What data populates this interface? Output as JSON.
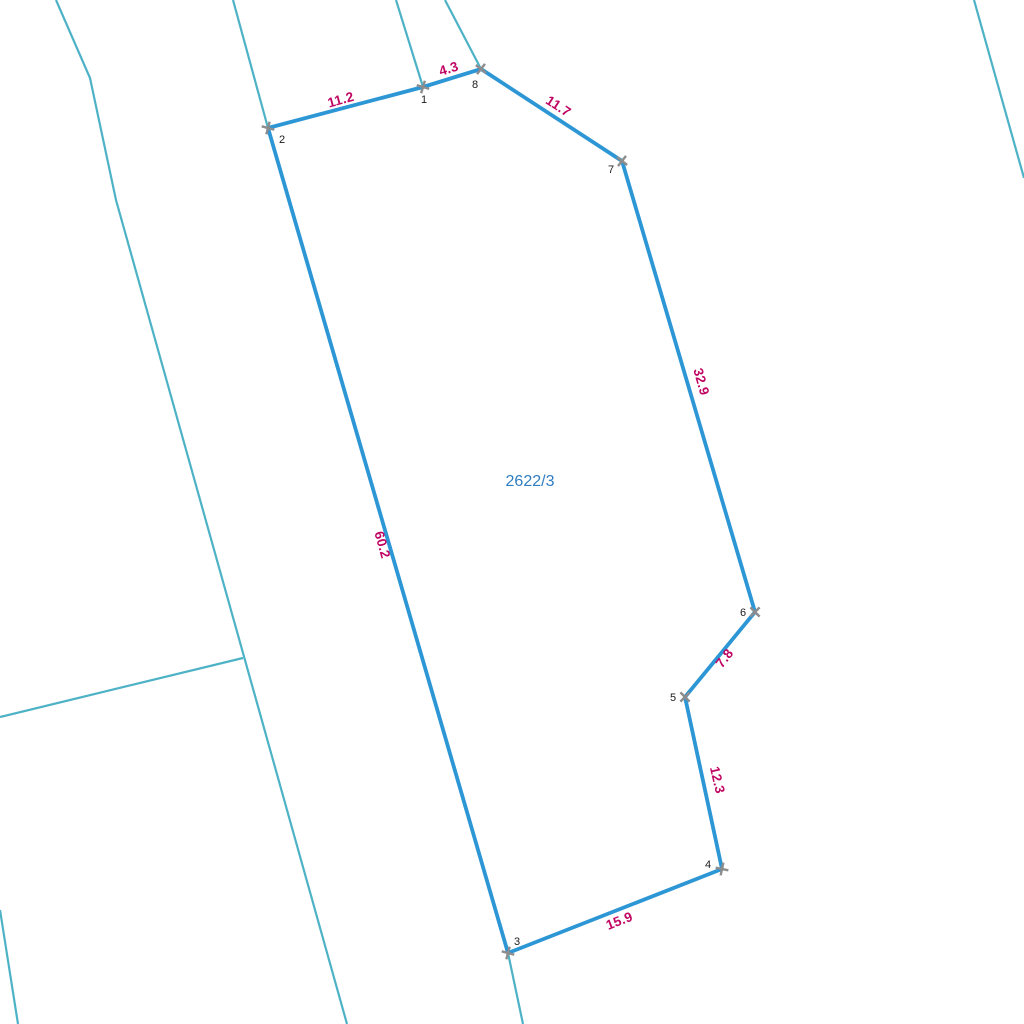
{
  "map": {
    "parcel": {
      "id": "2622/3",
      "label_pos": {
        "x": 530,
        "y": 486
      },
      "vertices": [
        {
          "n": "1",
          "x": 423,
          "y": 87,
          "label_x": 424,
          "label_y": 103,
          "marker_rot": 17
        },
        {
          "n": "2",
          "x": 268,
          "y": 128,
          "label_x": 282,
          "label_y": 143,
          "marker_rot": 15
        },
        {
          "n": "3",
          "x": 508,
          "y": 953,
          "label_x": 517,
          "label_y": 945,
          "marker_rot": 15
        },
        {
          "n": "4",
          "x": 722,
          "y": 869,
          "label_x": 708,
          "label_y": 868,
          "marker_rot": 12
        },
        {
          "n": "5",
          "x": 685,
          "y": 697,
          "label_x": 673,
          "label_y": 701,
          "marker_rot": 45
        },
        {
          "n": "6",
          "x": 755,
          "y": 612,
          "label_x": 743,
          "label_y": 616,
          "marker_rot": 45
        },
        {
          "n": "7",
          "x": 622,
          "y": 161,
          "label_x": 611,
          "label_y": 173,
          "marker_rot": 38
        },
        {
          "n": "8",
          "x": 481,
          "y": 69,
          "label_x": 475,
          "label_y": 88,
          "marker_rot": 38
        }
      ],
      "boundary_order": [
        "2",
        "1",
        "8",
        "7",
        "6",
        "5",
        "4",
        "3"
      ],
      "measurements": [
        {
          "value": "11.2",
          "x": 342,
          "y": 104,
          "rot": -15.5
        },
        {
          "value": "4.3",
          "x": 450,
          "y": 73,
          "rot": -17
        },
        {
          "value": "11.7",
          "x": 556,
          "y": 110,
          "rot": 33
        },
        {
          "value": "32.9",
          "x": 697,
          "y": 383,
          "rot": 74
        },
        {
          "value": "7.8",
          "x": 728,
          "y": 661,
          "rot": -52
        },
        {
          "value": "12.3",
          "x": 713,
          "y": 781,
          "rot": 77
        },
        {
          "value": "15.9",
          "x": 621,
          "y": 925,
          "rot": -21.5
        },
        {
          "value": "60.2",
          "x": 378,
          "y": 546,
          "rot": 74
        }
      ]
    },
    "background_lines": [
      {
        "points": "56,0 90,78 116,200 347,1024"
      },
      {
        "points": "243,658 0,717"
      },
      {
        "points": "0,910 18,1024"
      },
      {
        "points": "233,0 268,128"
      },
      {
        "points": "508,953 523,1024"
      },
      {
        "points": "396,0 423,87"
      },
      {
        "points": "445,0 481,69"
      },
      {
        "points": "974,0 1024,178"
      }
    ],
    "colors": {
      "boundary": "#2d96d5",
      "background_line": "#4eb2c6",
      "measurement": "#c00763",
      "parcel_label": "#2e7dc1",
      "vertex_marker": "#8d8d8d",
      "vertex_number": "#1c1c1c",
      "canvas": "#ffffff"
    }
  }
}
